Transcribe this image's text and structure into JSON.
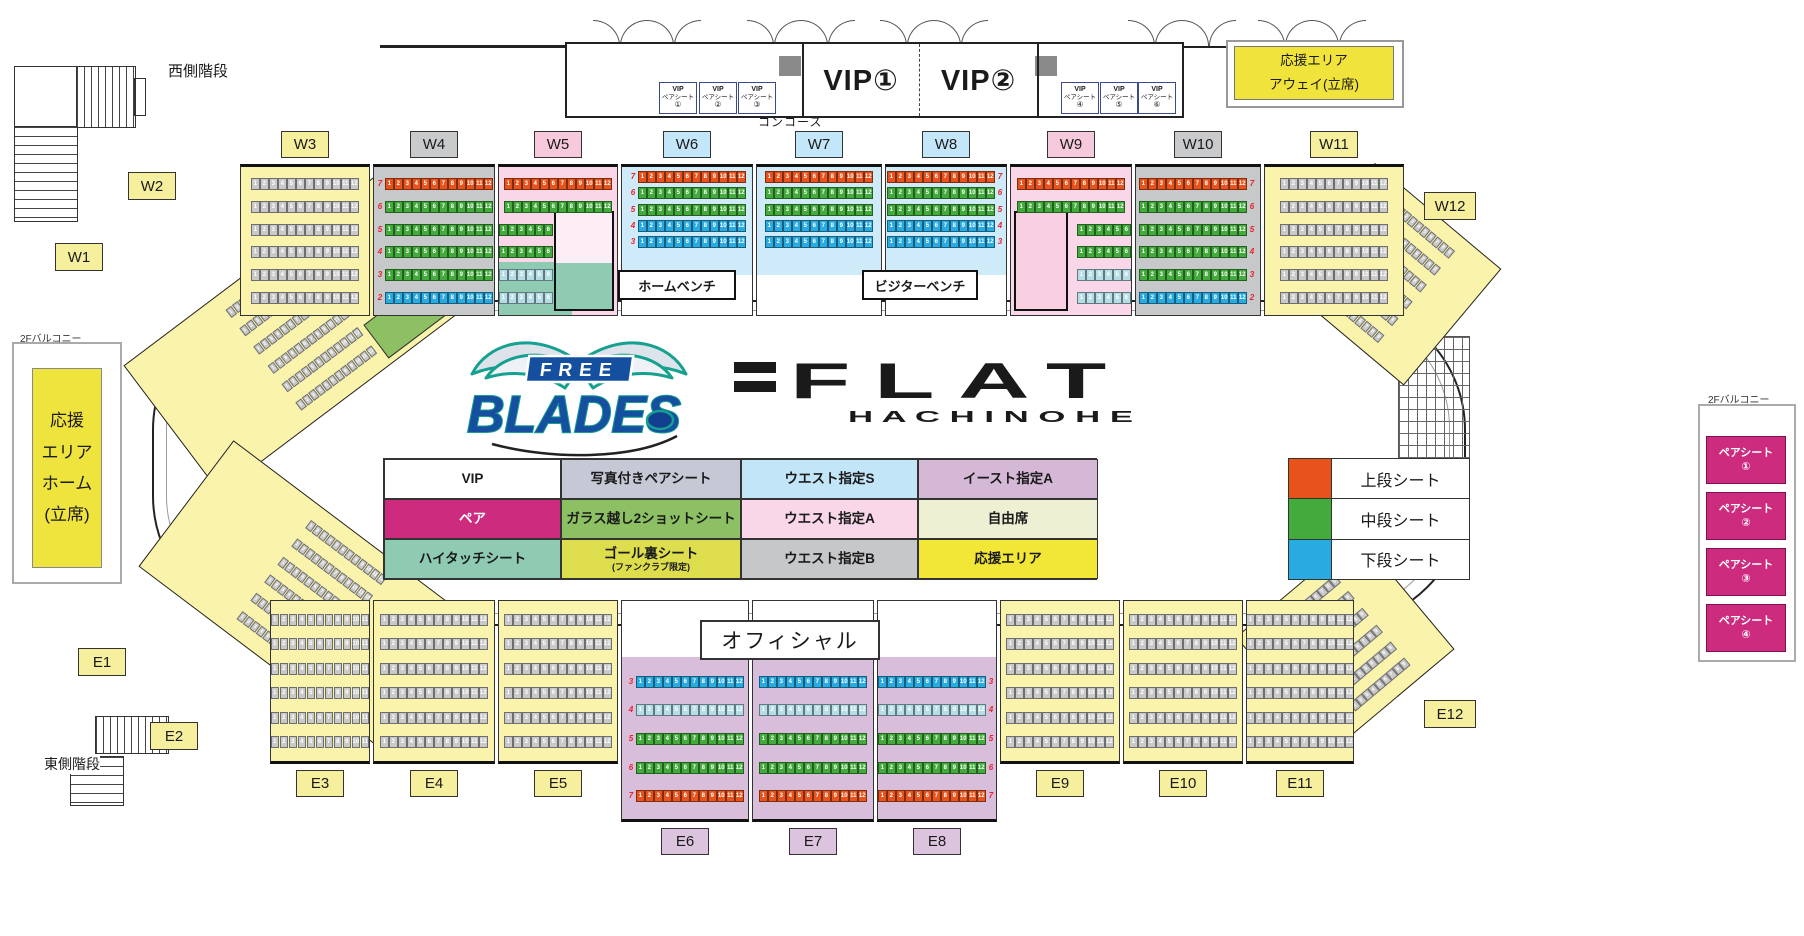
{
  "colors": {
    "tier": {
      "upper": "#e8531c",
      "middle": "#43ab3c",
      "lower": "#29abe2",
      "pale": "#b5dde6",
      "gray": "#c9c9c9"
    },
    "bg": {
      "yellow": "#faf3ab",
      "gray": "#c7c8ca",
      "pink": "#f9d7e8",
      "lightblue": "#cfeaf9",
      "purple": "#d8bedb"
    },
    "label_bg": {
      "yellow": "#f5ef9e",
      "gray": "#c9cacc",
      "pink": "#f7c9dd",
      "lightblue": "#c3e6f8",
      "purple": "#dcc3de"
    },
    "magenta": "#cc2b7e"
  },
  "stairs": {
    "west": "西側階段",
    "east": "東側階段"
  },
  "vip": {
    "rooms": [
      "VIP①",
      "VIP②"
    ],
    "pair_line1": "VIP",
    "pair_line2": "ペアシート",
    "left_numbers": [
      "①",
      "②",
      "③"
    ],
    "right_numbers": [
      "④",
      "⑤",
      "⑥"
    ],
    "concourse": "コンコース"
  },
  "away_area": {
    "line1": "応援エリア",
    "line2": "アウェイ(立席)"
  },
  "home_area": {
    "text": "応援\nエリア\nホーム\n(立席)"
  },
  "balcony_label": "2Fバルコニー",
  "right_balcony": {
    "pair_label": "ペアシート",
    "numbers": [
      "①",
      "②",
      "③",
      "④"
    ]
  },
  "benches": {
    "home": "ホームベンチ",
    "visitor": "ビジターベンチ",
    "official": "オフィシャル"
  },
  "logo": {
    "free": "FREE",
    "blades": "BLADES",
    "flat": "FLAT",
    "hachinohe": "H A C H I N O H E"
  },
  "corner_labels": {
    "W1": "W1",
    "W2": "W2",
    "W12": "W12",
    "E1": "E1",
    "E2": "E2",
    "E12": "E12"
  },
  "legend": {
    "cells": [
      {
        "t": "VIP",
        "bg": "#ffffff"
      },
      {
        "t": "写真付きペアシート",
        "bg": "#c5c9d6"
      },
      {
        "t": "ウエスト指定S",
        "bg": "#c3e5f8"
      },
      {
        "t": "イースト指定A",
        "bg": "#d5b8d6"
      },
      {
        "t": "ペア",
        "bg": "#cc2b7e",
        "fg": "#ffffff"
      },
      {
        "t": "ガラス越し2ショットシート",
        "bg": "#8cc063"
      },
      {
        "t": "ウエスト指定A",
        "bg": "#f9d7e8"
      },
      {
        "t": "自由席",
        "bg": "#edf0d2"
      },
      {
        "t": "ハイタッチシート",
        "bg": "#8fcbb3"
      },
      {
        "t": "ゴール裏シート",
        "sub": "(ファンクラブ限定)",
        "bg": "#dddd4e"
      },
      {
        "t": "ウエスト指定B",
        "bg": "#c6c7c9"
      },
      {
        "t": "応援エリア",
        "bg": "#f2e636"
      }
    ]
  },
  "tier_legend": [
    {
      "t": "上段シート",
      "c": "#e8531c"
    },
    {
      "t": "中段シート",
      "c": "#43ab3c"
    },
    {
      "t": "下段シート",
      "c": "#29abe2"
    }
  ],
  "sections": {
    "top": [
      {
        "id": "W3",
        "w": 130,
        "bg": "yellow",
        "rows": [
          [
            "",
            "gray",
            12
          ],
          [
            "",
            "gray",
            12
          ],
          [
            "",
            "gray",
            12
          ],
          [
            "",
            "gray",
            12
          ],
          [
            "",
            "gray",
            12
          ],
          [
            "",
            "gray",
            12
          ]
        ]
      },
      {
        "id": "W4",
        "w": 122,
        "bg": "gray",
        "nums": "left",
        "rows": [
          [
            "7",
            "upper",
            12
          ],
          [
            "6",
            "middle",
            12
          ],
          [
            "5",
            "middle",
            12
          ],
          [
            "4",
            "middle",
            12
          ],
          [
            "3",
            "middle",
            12
          ],
          [
            "2",
            "lower",
            12
          ]
        ]
      },
      {
        "id": "W5",
        "w": 120,
        "bg": "pink",
        "room": "right",
        "teal": true,
        "short_align": "left",
        "rows": [
          [
            "",
            "upper",
            12
          ],
          [
            "",
            "middle",
            12
          ],
          [
            "",
            "middle",
            6
          ],
          [
            "",
            "middle",
            6
          ],
          [
            "",
            "pale",
            6
          ],
          [
            "",
            "pale",
            6
          ]
        ]
      },
      {
        "id": "W6",
        "w": 132,
        "bg": "lightblue",
        "nums": "left",
        "bench_gap": true,
        "rows": [
          [
            "7",
            "upper",
            12
          ],
          [
            "6",
            "middle",
            12
          ],
          [
            "5",
            "middle",
            12
          ],
          [
            "4",
            "lower",
            12
          ],
          [
            "3",
            "lower",
            12
          ]
        ]
      },
      {
        "id": "W7",
        "w": 126,
        "bg": "lightblue",
        "bench_gap": true,
        "rows": [
          [
            "",
            "upper",
            12
          ],
          [
            "",
            "middle",
            12
          ],
          [
            "",
            "middle",
            12
          ],
          [
            "",
            "lower",
            12
          ],
          [
            "",
            "lower",
            12
          ]
        ]
      },
      {
        "id": "W8",
        "w": 122,
        "bg": "lightblue",
        "nums": "right",
        "bench_gap": true,
        "rows": [
          [
            "7",
            "upper",
            12
          ],
          [
            "6",
            "middle",
            12
          ],
          [
            "5",
            "middle",
            12
          ],
          [
            "4",
            "lower",
            12
          ],
          [
            "3",
            "lower",
            12
          ]
        ]
      },
      {
        "id": "W9",
        "w": 122,
        "bg": "pink",
        "room": "left",
        "short_align": "right",
        "rows": [
          [
            "",
            "upper",
            12
          ],
          [
            "",
            "middle",
            12
          ],
          [
            "",
            "middle",
            6
          ],
          [
            "",
            "middle",
            6
          ],
          [
            "",
            "pale",
            6
          ],
          [
            "",
            "pale",
            6
          ]
        ]
      },
      {
        "id": "W10",
        "w": 126,
        "bg": "gray",
        "nums": "right",
        "rows": [
          [
            "7",
            "upper",
            12
          ],
          [
            "6",
            "middle",
            12
          ],
          [
            "5",
            "middle",
            12
          ],
          [
            "4",
            "middle",
            12
          ],
          [
            "3",
            "middle",
            12
          ],
          [
            "2",
            "lower",
            12
          ]
        ]
      },
      {
        "id": "W11",
        "w": 140,
        "bg": "yellow",
        "rows": [
          [
            "",
            "gray",
            12
          ],
          [
            "",
            "gray",
            12
          ],
          [
            "",
            "gray",
            12
          ],
          [
            "",
            "gray",
            12
          ],
          [
            "",
            "gray",
            12
          ],
          [
            "",
            "gray",
            12
          ]
        ]
      }
    ],
    "bottom": [
      {
        "id": "E3",
        "w": 100,
        "bg": "yellow",
        "rows": [
          [
            "",
            "gray",
            11
          ],
          [
            "",
            "gray",
            11
          ],
          [
            "",
            "gray",
            11
          ],
          [
            "",
            "gray",
            11
          ],
          [
            "",
            "gray",
            11
          ],
          [
            "",
            "gray",
            11
          ]
        ]
      },
      {
        "id": "E4",
        "w": 122,
        "bg": "yellow",
        "rows": [
          [
            "",
            "gray",
            12
          ],
          [
            "",
            "gray",
            12
          ],
          [
            "",
            "gray",
            12
          ],
          [
            "",
            "gray",
            12
          ],
          [
            "",
            "gray",
            12
          ],
          [
            "",
            "gray",
            12
          ]
        ]
      },
      {
        "id": "E5",
        "w": 120,
        "bg": "yellow",
        "rows": [
          [
            "",
            "gray",
            12
          ],
          [
            "",
            "gray",
            12
          ],
          [
            "",
            "gray",
            12
          ],
          [
            "",
            "gray",
            12
          ],
          [
            "",
            "gray",
            12
          ],
          [
            "",
            "gray",
            12
          ]
        ]
      },
      {
        "id": "E6",
        "w": 128,
        "bg": "purple",
        "corridor": true,
        "nums": "left",
        "rows": [
          [
            "3",
            "lower",
            12
          ],
          [
            "4",
            "pale",
            12
          ],
          [
            "5",
            "middle",
            12
          ],
          [
            "6",
            "middle",
            12
          ],
          [
            "7",
            "upper",
            12
          ]
        ]
      },
      {
        "id": "E7",
        "w": 122,
        "bg": "purple",
        "corridor": true,
        "rows": [
          [
            "",
            "lower",
            12
          ],
          [
            "",
            "pale",
            12
          ],
          [
            "",
            "middle",
            12
          ],
          [
            "",
            "middle",
            12
          ],
          [
            "",
            "upper",
            12
          ]
        ]
      },
      {
        "id": "E8",
        "w": 120,
        "bg": "purple",
        "corridor": true,
        "nums": "right",
        "rows": [
          [
            "3",
            "lower",
            12
          ],
          [
            "4",
            "pale",
            12
          ],
          [
            "5",
            "middle",
            12
          ],
          [
            "6",
            "middle",
            12
          ],
          [
            "7",
            "upper",
            12
          ]
        ]
      },
      {
        "id": "E9",
        "w": 120,
        "bg": "yellow",
        "rows": [
          [
            "",
            "gray",
            12
          ],
          [
            "",
            "gray",
            12
          ],
          [
            "",
            "gray",
            12
          ],
          [
            "",
            "gray",
            12
          ],
          [
            "",
            "gray",
            12
          ],
          [
            "",
            "gray",
            12
          ]
        ]
      },
      {
        "id": "E10",
        "w": 120,
        "bg": "yellow",
        "rows": [
          [
            "",
            "gray",
            12
          ],
          [
            "",
            "gray",
            12
          ],
          [
            "",
            "gray",
            12
          ],
          [
            "",
            "gray",
            12
          ],
          [
            "",
            "gray",
            12
          ],
          [
            "",
            "gray",
            12
          ]
        ]
      },
      {
        "id": "E11",
        "w": 108,
        "bg": "yellow",
        "rows": [
          [
            "",
            "gray",
            12
          ],
          [
            "",
            "gray",
            12
          ],
          [
            "",
            "gray",
            12
          ],
          [
            "",
            "gray",
            12
          ],
          [
            "",
            "gray",
            12
          ],
          [
            "",
            "gray",
            12
          ]
        ]
      }
    ]
  }
}
